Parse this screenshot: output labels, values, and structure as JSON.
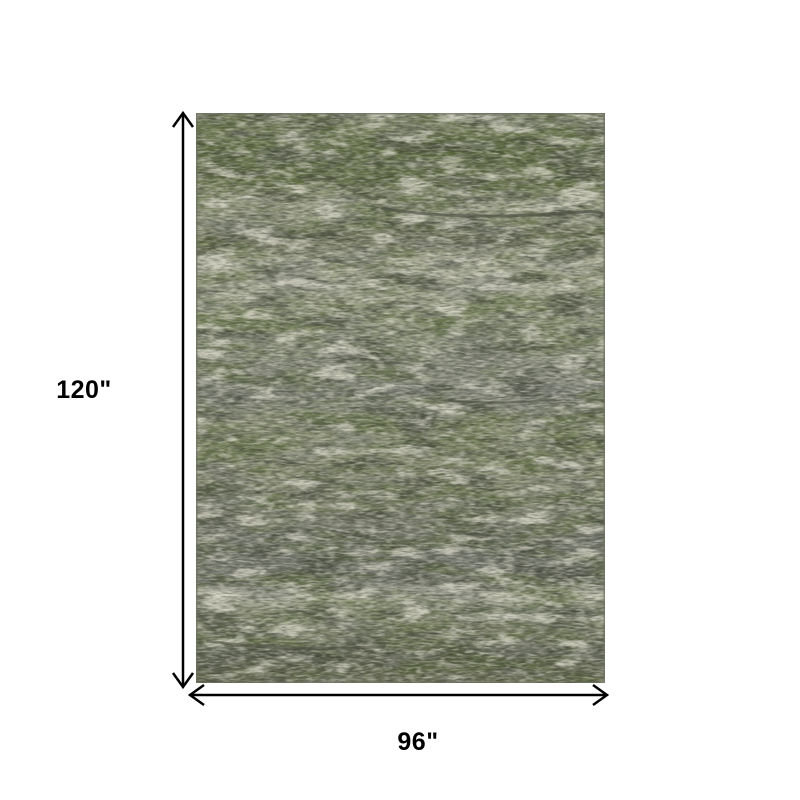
{
  "page": {
    "background_color": "#ffffff"
  },
  "dimensions": {
    "height_label": "120\"",
    "width_label": "96\"",
    "line_color": "#000000",
    "label_color": "#000000"
  },
  "rug": {
    "alt": "Distressed abstract area rug in olive green, sage, grey and cream",
    "palette": {
      "base": "#8f957d",
      "olive": "#5a683a",
      "sage": "#9aa086",
      "grey": "#75786f",
      "dark": "#474c3c",
      "cream": "#dcdbcb",
      "speckle_dark": "#2f332b",
      "speckle_light": "#e6e5d8",
      "crack": "#4a4d40",
      "edge": "#6b6f60"
    }
  }
}
